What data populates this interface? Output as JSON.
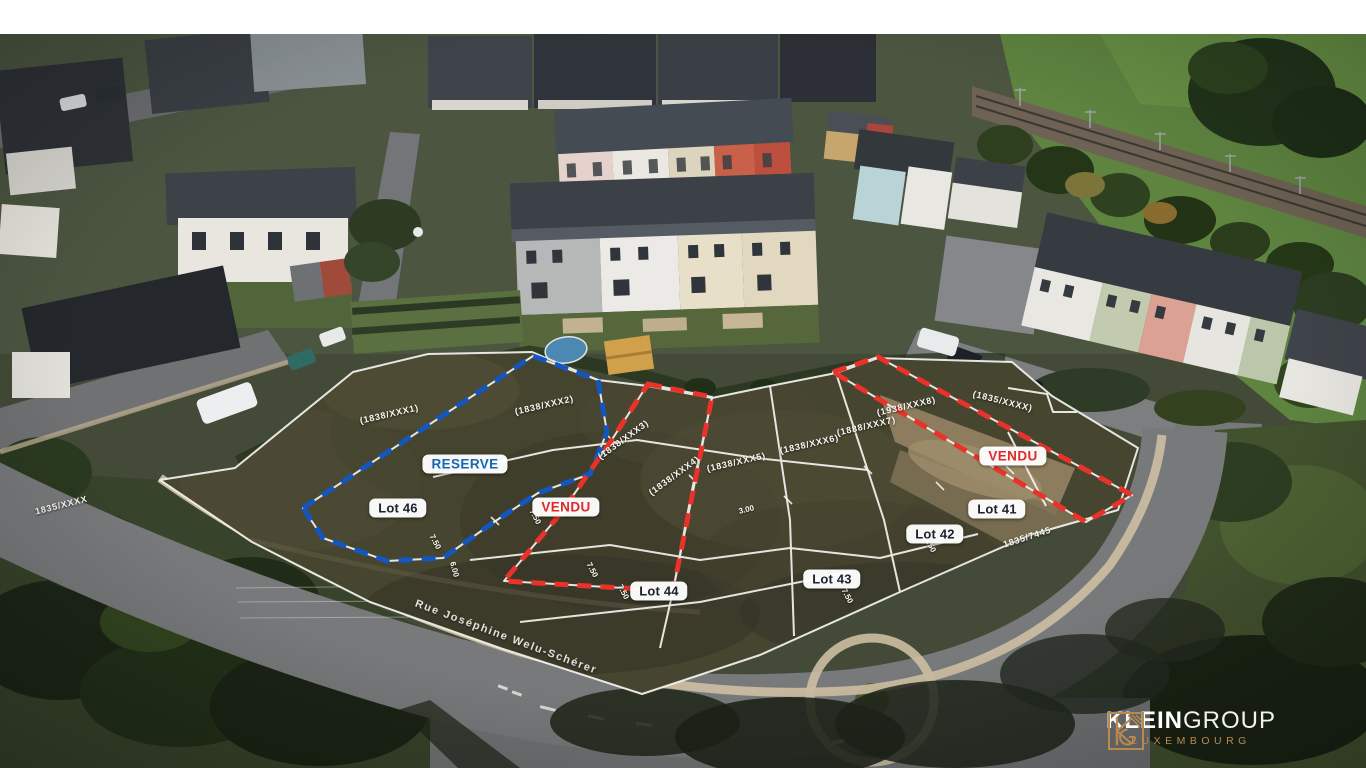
{
  "annotations": {
    "status_badges": [
      {
        "id": "reserve",
        "label": "RESERVE",
        "color": "#1668b3"
      },
      {
        "id": "vendu-left",
        "label": "VENDU",
        "color": "#e0282a"
      },
      {
        "id": "vendu-right",
        "label": "VENDU",
        "color": "#e0282a"
      }
    ],
    "lot_badges": [
      {
        "id": "lot-46",
        "label": "Lot 46"
      },
      {
        "id": "lot-44",
        "label": "Lot 44"
      },
      {
        "id": "lot-43",
        "label": "Lot 43"
      },
      {
        "id": "lot-42",
        "label": "Lot 42"
      },
      {
        "id": "lot-41",
        "label": "Lot 41"
      }
    ],
    "lot_text_color": "#1b2330",
    "parcel_refs": [
      "(1838/XXX1)",
      "(1838/XXX2)",
      "(1838/XXX3)",
      "(1838/XXX4)",
      "(1838/XXX5)",
      "(1838/XXX6)",
      "(1888/XXX7)",
      "(1938/XXX8)",
      "(1835/XXXX)"
    ],
    "dimension_marks": [
      "7.50",
      "7.50",
      "7.50",
      "7.50",
      "7.50",
      "3.00",
      "6.00",
      "2.50"
    ],
    "street_name": "Rue Joséphine Welu-Schérer",
    "road_parcel_ref": "1835/7445",
    "roadside_parcel_ref": "1835/XXXX",
    "boundary_colors": {
      "available": "#f5f3ee",
      "reserved": "#1456c0",
      "sold": "#e8322a"
    }
  },
  "logo": {
    "name_primary": "KLEIN",
    "name_secondary": "GROUP",
    "region": "LUXEMBOURG",
    "accent_color": "#b98a4f"
  }
}
